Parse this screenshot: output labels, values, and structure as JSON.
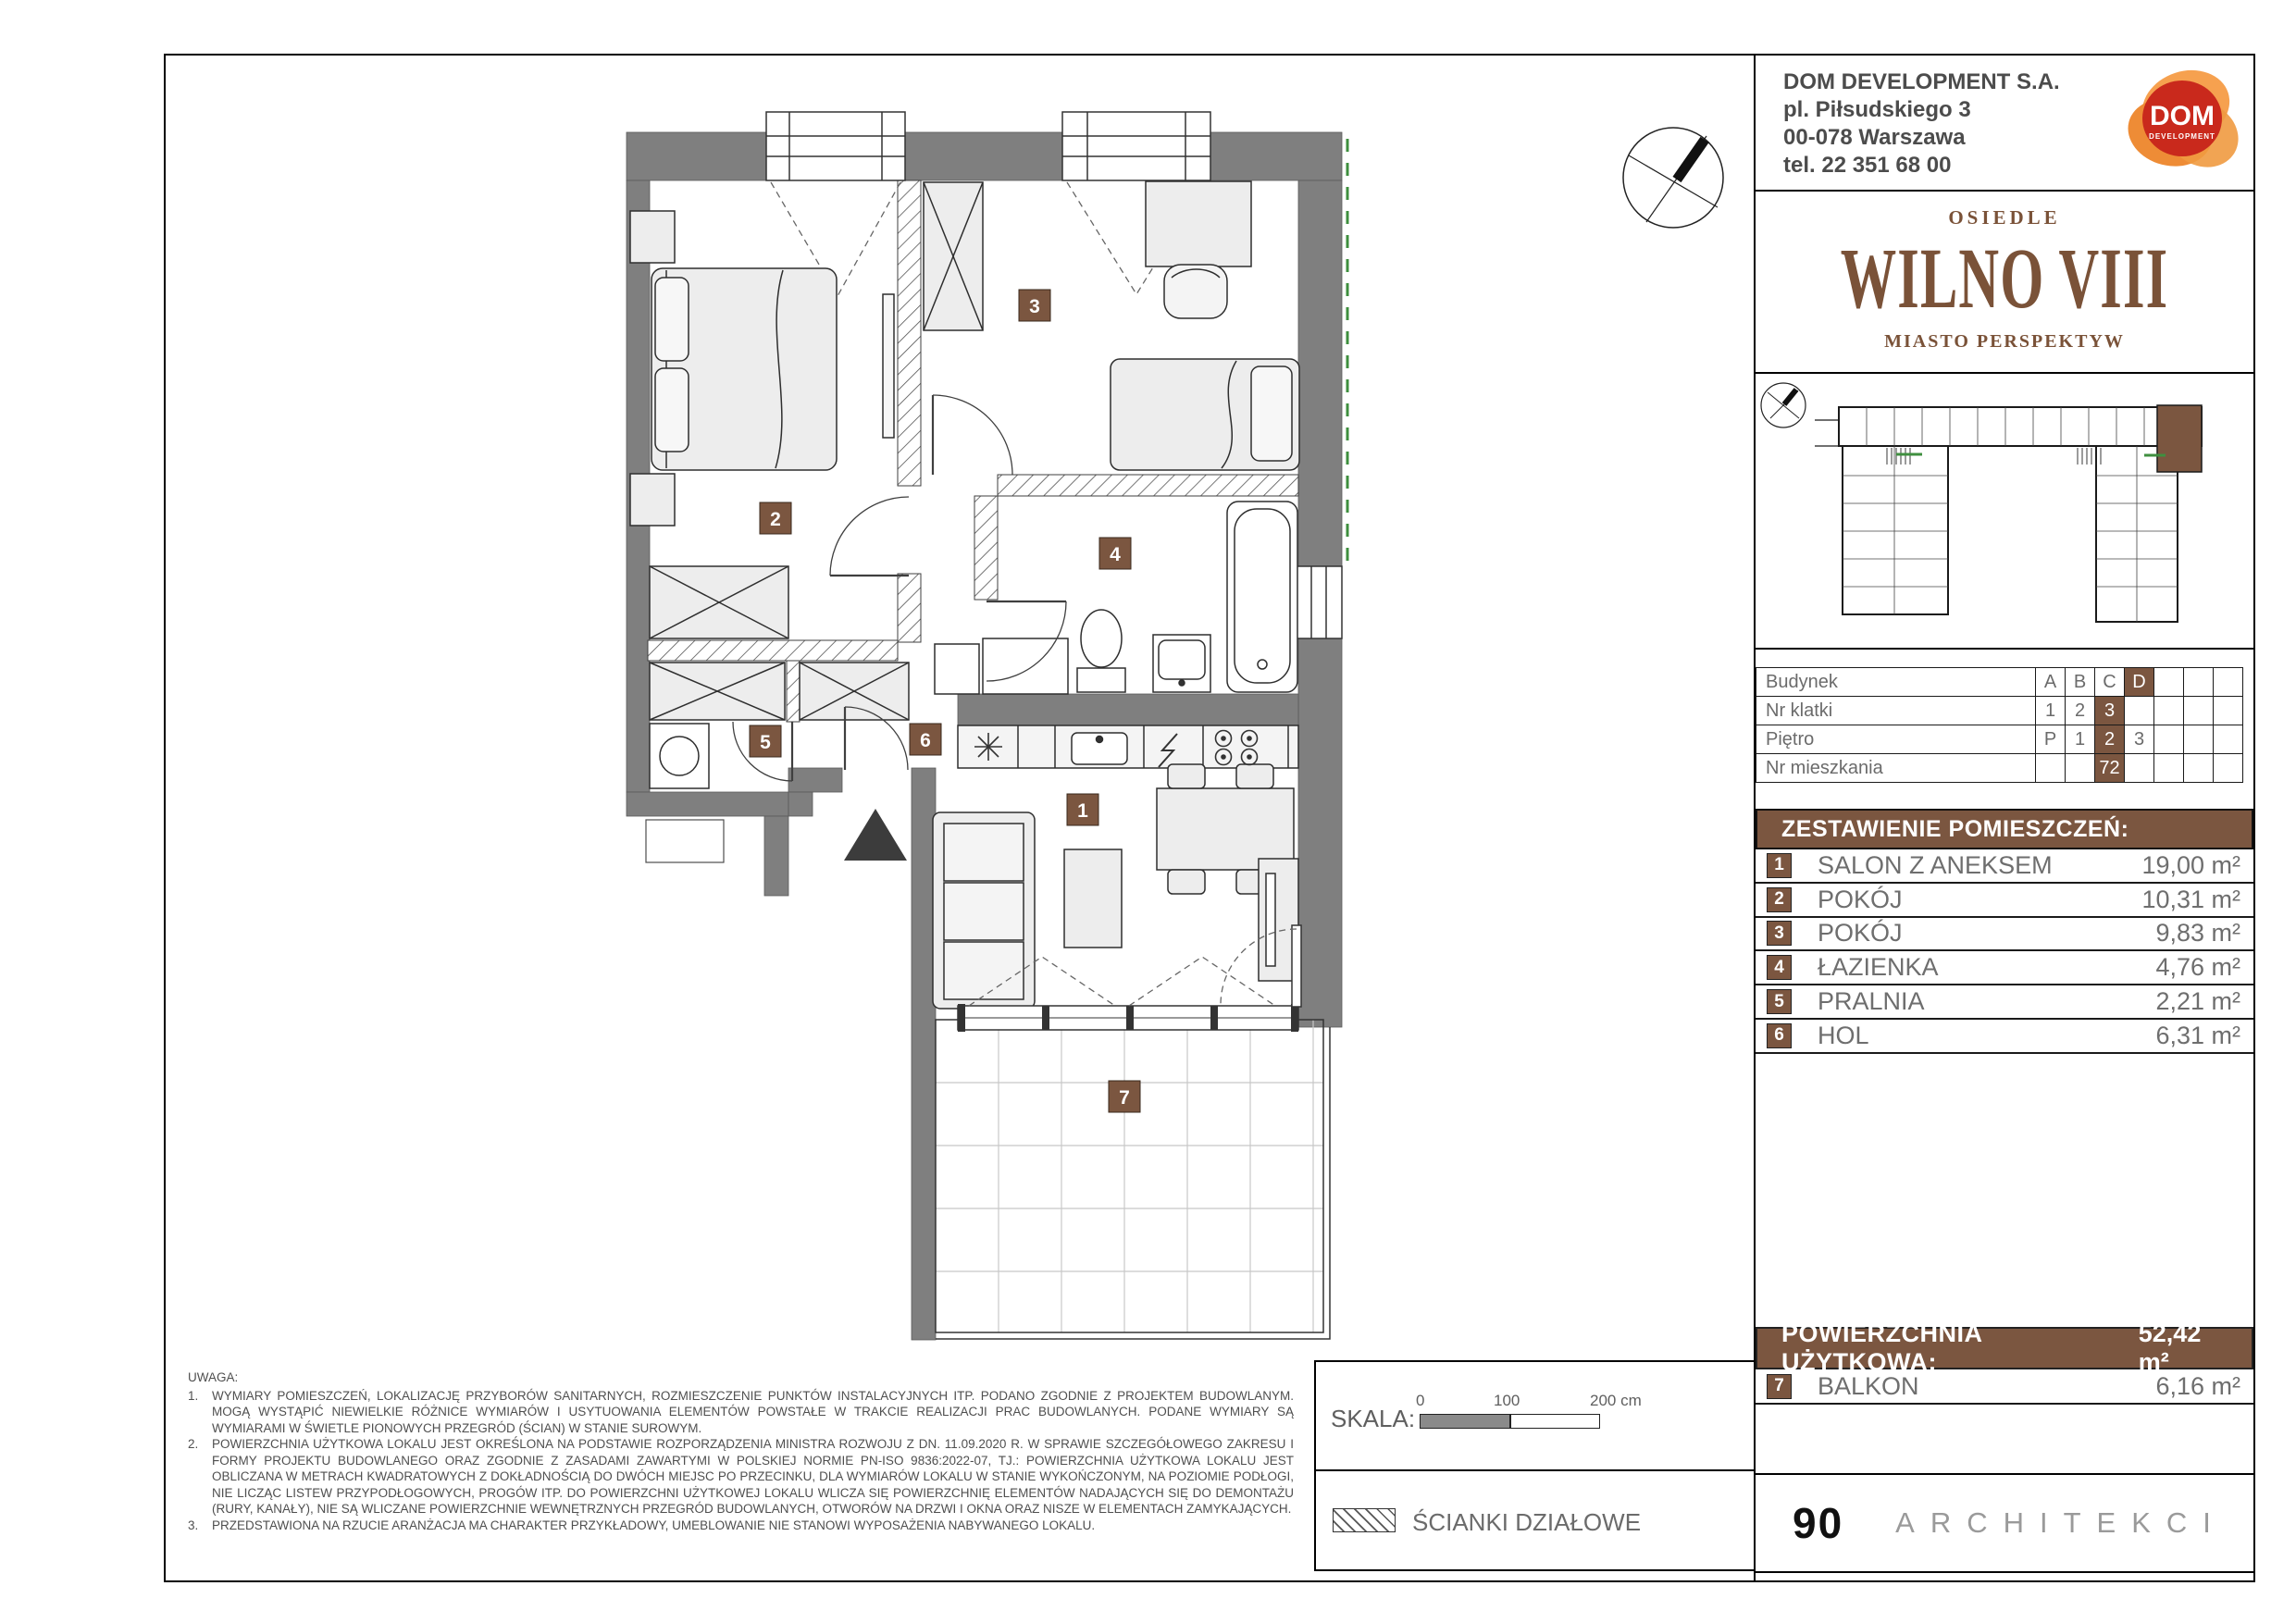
{
  "developer": {
    "name": "DOM DEVELOPMENT S.A.",
    "address_line1": "pl. Piłsudskiego 3",
    "address_line2": "00-078 Warszawa",
    "phone": "tel. 22 351 68 00",
    "logo_text": "DOM",
    "logo_subtext": "DEVELOPMENT"
  },
  "estate": {
    "pre": "OSIEDLE",
    "name": "WILNO VIII",
    "tagline": "MIASTO PERSPEKTYW"
  },
  "location_table": {
    "rows": [
      {
        "label": "Budynek",
        "cells": [
          "A",
          "B",
          "C",
          "D",
          "",
          "",
          ""
        ],
        "highlight_index": 3
      },
      {
        "label": "Nr klatki",
        "cells": [
          "1",
          "2",
          "3",
          "",
          "",
          "",
          ""
        ],
        "highlight_index": 2
      },
      {
        "label": "Piętro",
        "cells": [
          "P",
          "1",
          "2",
          "3",
          "",
          "",
          ""
        ],
        "highlight_index": 2
      },
      {
        "label": "Nr mieszkania",
        "cells": [
          "",
          "",
          "72",
          "",
          "",
          "",
          ""
        ],
        "highlight_index": 2
      }
    ]
  },
  "rooms": {
    "header": "ZESTAWIENIE POMIESZCZEŃ:",
    "items": [
      {
        "no": "1",
        "name": "SALON Z ANEKSEM",
        "area": "19,00 m²"
      },
      {
        "no": "2",
        "name": "POKÓJ",
        "area": "10,31 m²"
      },
      {
        "no": "3",
        "name": "POKÓJ",
        "area": "9,83 m²"
      },
      {
        "no": "4",
        "name": "ŁAZIENKA",
        "area": "4,76 m²"
      },
      {
        "no": "5",
        "name": "PRALNIA",
        "area": "2,21 m²"
      },
      {
        "no": "6",
        "name": "HOL",
        "area": "6,31 m²"
      }
    ]
  },
  "summary": {
    "label": "POWIERZCHNIA UŻYTKOWA:",
    "value": "52,42 m²"
  },
  "balcony": {
    "no": "7",
    "name": "BALKON",
    "area": "6,16 m²"
  },
  "notes": {
    "label": "UWAGA:",
    "items": [
      {
        "num": "1.",
        "text": "WYMIARY POMIESZCZEŃ, LOKALIZACJĘ PRZYBORÓW SANITARNYCH, ROZMIESZCZENIE PUNKTÓW INSTALACYJNYCH ITP. PODANO ZGODNIE Z PROJEKTEM BUDOWLANYM. MOGĄ WYSTĄPIĆ NIEWIELKIE RÓŻNICE WYMIARÓW I USYTUOWANIA ELEMENTÓW POWSTAŁE W TRAKCIE REALIZACJI PRAC BUDOWLANYCH. PODANE WYMIARY SĄ WYMIARAMI W ŚWIETLE PIONOWYCH PRZEGRÓD (ŚCIAN) W STANIE SUROWYM."
      },
      {
        "num": "2.",
        "text": "POWIERZCHNIA UŻYTKOWA LOKALU JEST OKREŚLONA NA PODSTAWIE ROZPORZĄDZENIA MINISTRA ROZWOJU Z DN. 11.09.2020 R. W SPRAWIE SZCZEGÓŁOWEGO ZAKRESU I FORMY PROJEKTU BUDOWLANEGO ORAZ ZGODNIE Z ZASADAMI ZAWARTYMI W POLSKIEJ NORMIE PN-ISO 9836:2022-07, TJ.: POWIERZCHNIA UŻYTKOWA LOKALU JEST OBLICZANA W METRACH KWADRATOWYCH Z DOKŁADNOŚCIĄ DO DWÓCH MIEJSC PO PRZECINKU, DLA WYMIARÓW LOKALU W STANIE WYKOŃCZONYM, NA POZIOMIE PODŁOGI, NIE LICZĄC LISTEW PRZYPODŁOGOWYCH, PROGÓW ITP. DO POWIERZCHNI UŻYTKOWEJ LOKALU WLICZA SIĘ POWIERZCHNIĘ ELEMENTÓW NADAJĄCYCH SIĘ DO DEMONTAŻU (RURY, KANAŁY), NIE SĄ WLICZANE POWIERZCHNIE WEWNĘTRZNYCH PRZEGRÓD BUDOWLANYCH, OTWORÓW NA DRZWI I OKNA ORAZ NISZE W ELEMENTACH ZAMYKAJĄCYCH."
      },
      {
        "num": "3.",
        "text": "PRZEDSTAWIONA NA RZUCIE ARANŻACJA MA CHARAKTER PRZYKŁADOWY, UMEBLOWANIE NIE STANOWI WYPOSAŻENIA NABYWANEGO LOKALU."
      }
    ]
  },
  "scale": {
    "label": "SKALA:",
    "tick0": "0",
    "tick100": "100",
    "tick200": "200 cm"
  },
  "legend": {
    "partition_walls": "ŚCIANKI DZIAŁOWE"
  },
  "architect": {
    "number": "90",
    "name": "ARCHITEKCI"
  },
  "plan": {
    "room_labels": [
      "1",
      "2",
      "3",
      "4",
      "5",
      "6",
      "7"
    ]
  },
  "colors": {
    "brand_brown": "#7a5238",
    "highlight_brown": "#7b5640",
    "wall_gray": "#7f7f7f",
    "accent_green": "#3f8f3f",
    "logo_orange": "#f6a14f",
    "logo_red": "#c9291c"
  }
}
